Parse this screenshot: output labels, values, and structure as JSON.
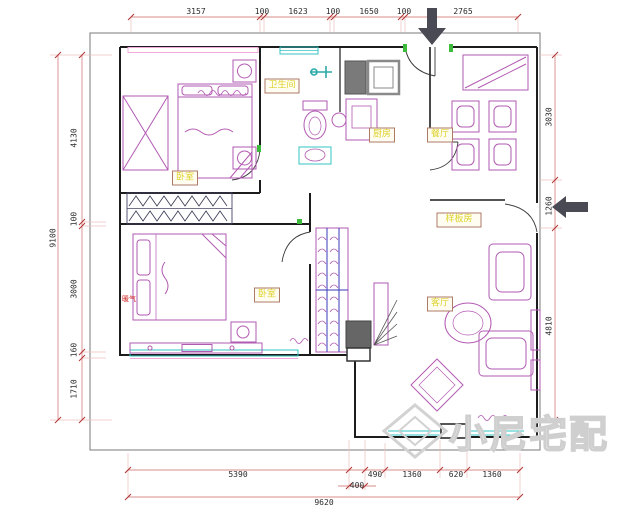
{
  "plan": {
    "dims_top": [
      "3157",
      "100",
      "1623",
      "100",
      "1650",
      "100",
      "2765"
    ],
    "dims_left_total": "9100",
    "dims_left": [
      "4130",
      "100",
      "3000",
      "160",
      "1710"
    ],
    "dims_right": [
      "3030",
      "1260",
      "4810"
    ],
    "dims_bottom": [
      "5390",
      "490",
      "1360",
      "620",
      "1360"
    ],
    "dims_bottom_sub": "400",
    "dims_bottom_total": "9620",
    "rooms": {
      "bedroom_top": "卧室",
      "bathroom": "卫生间",
      "kitchen": "厨房",
      "dining": "餐厅",
      "model_room": "样板房",
      "bedroom_bottom": "卧室",
      "living_room": "客厅",
      "heater_note": "暖气"
    },
    "watermark": "小尼宅配",
    "colors": {
      "wall": "#1c1c1c",
      "dimension_line": "#d98b8b",
      "dimension_tick": "#b03232",
      "furniture": "#b25ab2",
      "window_cyan": "#35c4c4",
      "window_pink": "#f2a9dc",
      "door_frame_green": "#3dbb3d",
      "label_text": "#ddd22a",
      "label_border": "#ad7a66",
      "arrow": "#4a4a54",
      "watermark_gray": "#d5d5d5"
    }
  }
}
